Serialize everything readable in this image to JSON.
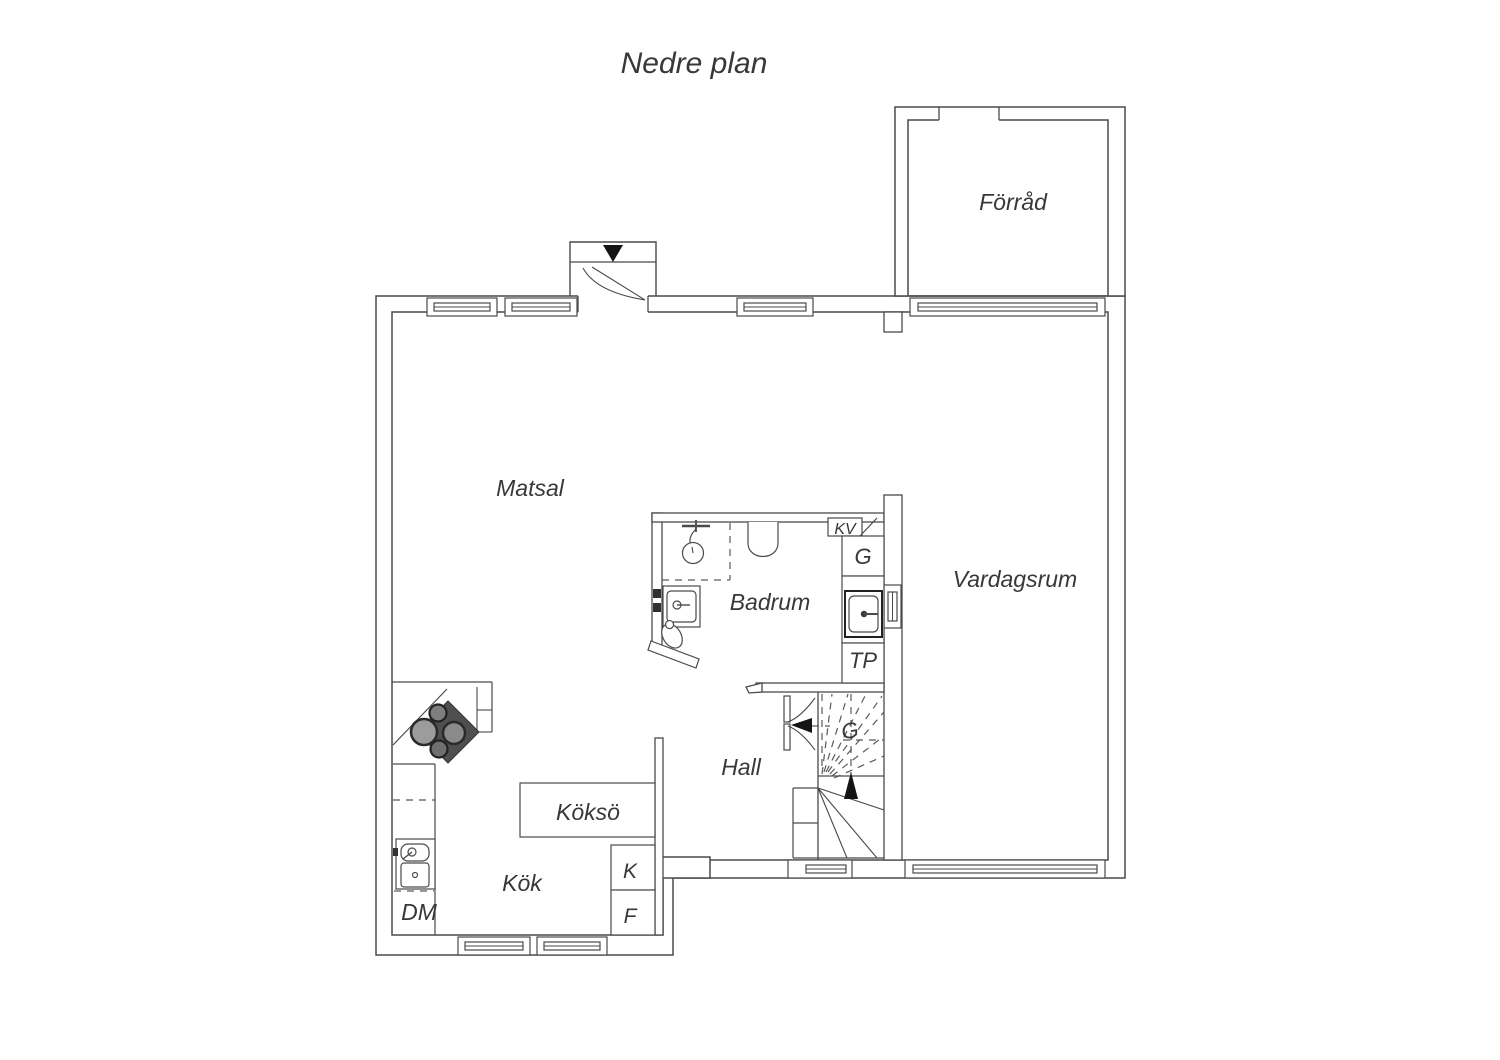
{
  "title": "Nedre plan",
  "labels": {
    "forrad": "Förråd",
    "matsal": "Matsal",
    "vardagsrum": "Vardagsrum",
    "badrum": "Badrum",
    "hall": "Hall",
    "kokso": "Köksö",
    "kok": "Kök",
    "dm": "DM",
    "kyl": "K",
    "frys": "F",
    "tp": "TP",
    "garderob": "G",
    "kv": "KV",
    "garderob_stairs": "G"
  },
  "icons": {
    "entrance_arrow": "triangle-down",
    "stair_up_arrow": "triangle-up",
    "stair_direction_arrow": "triangle-left"
  },
  "colors": {
    "wall_line": "#4a4a4a",
    "text": "#383838",
    "stove_body": "#4f4f4f",
    "arrow": "#141414",
    "background": "#ffffff"
  }
}
